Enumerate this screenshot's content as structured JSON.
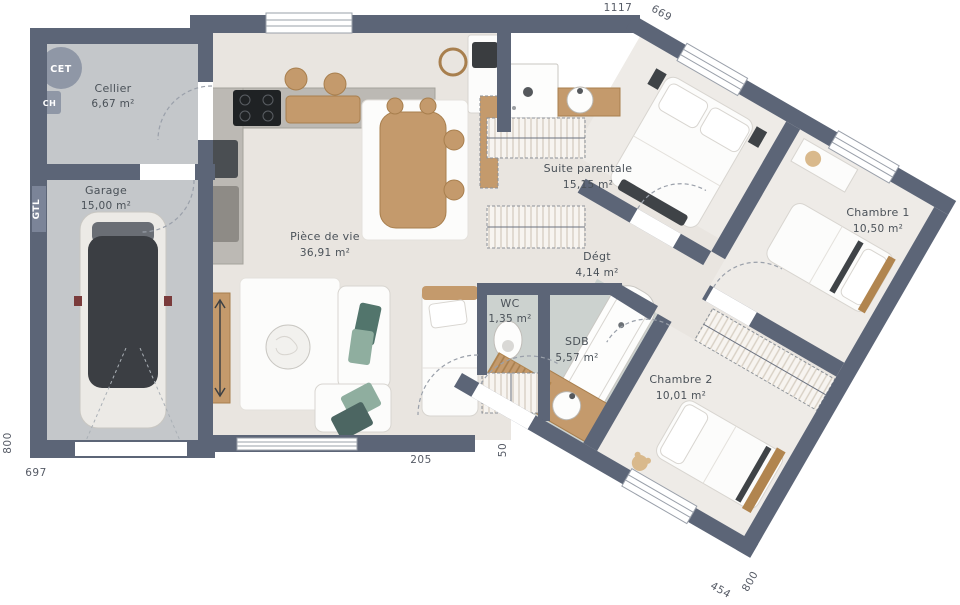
{
  "rooms": {
    "cellier": {
      "name": "Cellier",
      "area": "6,67 m²"
    },
    "garage": {
      "name": "Garage",
      "area": "15,00 m²"
    },
    "piece_de_vie": {
      "name": "Pièce de vie",
      "area": "36,91 m²"
    },
    "suite_parentale": {
      "name": "Suite parentale",
      "area": "15,15 m²"
    },
    "degagement": {
      "name": "Dégt",
      "area": "4,14 m²"
    },
    "wc": {
      "name": "WC",
      "area": "1,35 m²"
    },
    "sdb": {
      "name": "SDB",
      "area": "5,57 m²"
    },
    "chambre1": {
      "name": "Chambre 1",
      "area": "10,50 m²"
    },
    "chambre2": {
      "name": "Chambre 2",
      "area": "10,01 m²"
    }
  },
  "equipment": {
    "cet": "CET",
    "ch": "CH",
    "gtl": "GTL"
  },
  "dimensions": {
    "top": "1117",
    "top_right": "669",
    "left": "800",
    "bottom_left": "697",
    "entry_width": "205",
    "entry_depth": "50",
    "bottom_right_width": "454",
    "bottom_right_depth": "800"
  },
  "colors": {
    "wall": "#5c6577",
    "floor": "#e9e5e0",
    "floor_soft": "#eeebe7",
    "floor_wet": "#ccd2cf",
    "floor_garage": "#c4c7ca",
    "wood": "#c49a6c",
    "accent_dark": "#3c4044"
  }
}
